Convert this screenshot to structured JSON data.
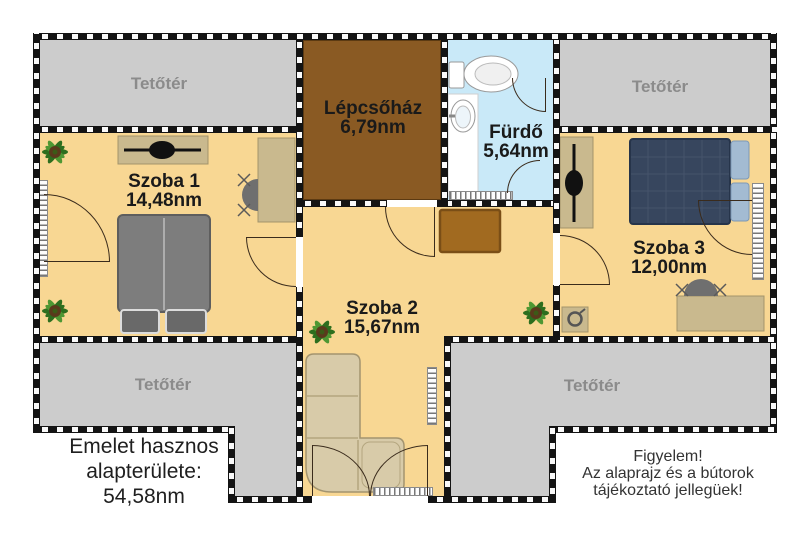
{
  "plan": {
    "attic_label": "Tetőtér",
    "staircase": {
      "name": "Lépcsőház",
      "area": "6,79nm"
    },
    "bathroom": {
      "name": "Fürdő",
      "area": "5,64nm"
    },
    "room1": {
      "name": "Szoba 1",
      "area": "14,48nm"
    },
    "room2": {
      "name": "Szoba 2",
      "area": "15,67nm"
    },
    "room3": {
      "name": "Szoba 3",
      "area": "12,00nm"
    }
  },
  "notes": {
    "left": {
      "line1": "Emelet hasznos",
      "line2": "alapterülete:",
      "line3": "54,58nm"
    },
    "right": {
      "line1": "Figyelem!",
      "line2": "Az alaprajz és a bútorok",
      "line3": "tájékoztató jellegüek!"
    }
  },
  "colors": {
    "floor": "#F8D793",
    "attic": "#CCCCCC",
    "staircase": "#8A5A23",
    "bathroom": "#C9E9F8",
    "wall": "#141414",
    "furniture_tan": "#C9B98E",
    "sofa": "#D8CBA9",
    "bed_gray": "#7D7D7D",
    "bed_navy": "#37465E",
    "pillow_blue": "#A3BBD2",
    "chest_brown": "#A16A20",
    "plant_green": "#2D6E1E",
    "attic_label_gray": "#8B8B8B"
  },
  "furniture_icons": [
    "double-bed",
    "pillow",
    "tv",
    "shelf",
    "desk",
    "office-chair",
    "corner-sofa",
    "chest",
    "potted-plant",
    "toilet",
    "washbasin",
    "radiator",
    "nightstand"
  ]
}
